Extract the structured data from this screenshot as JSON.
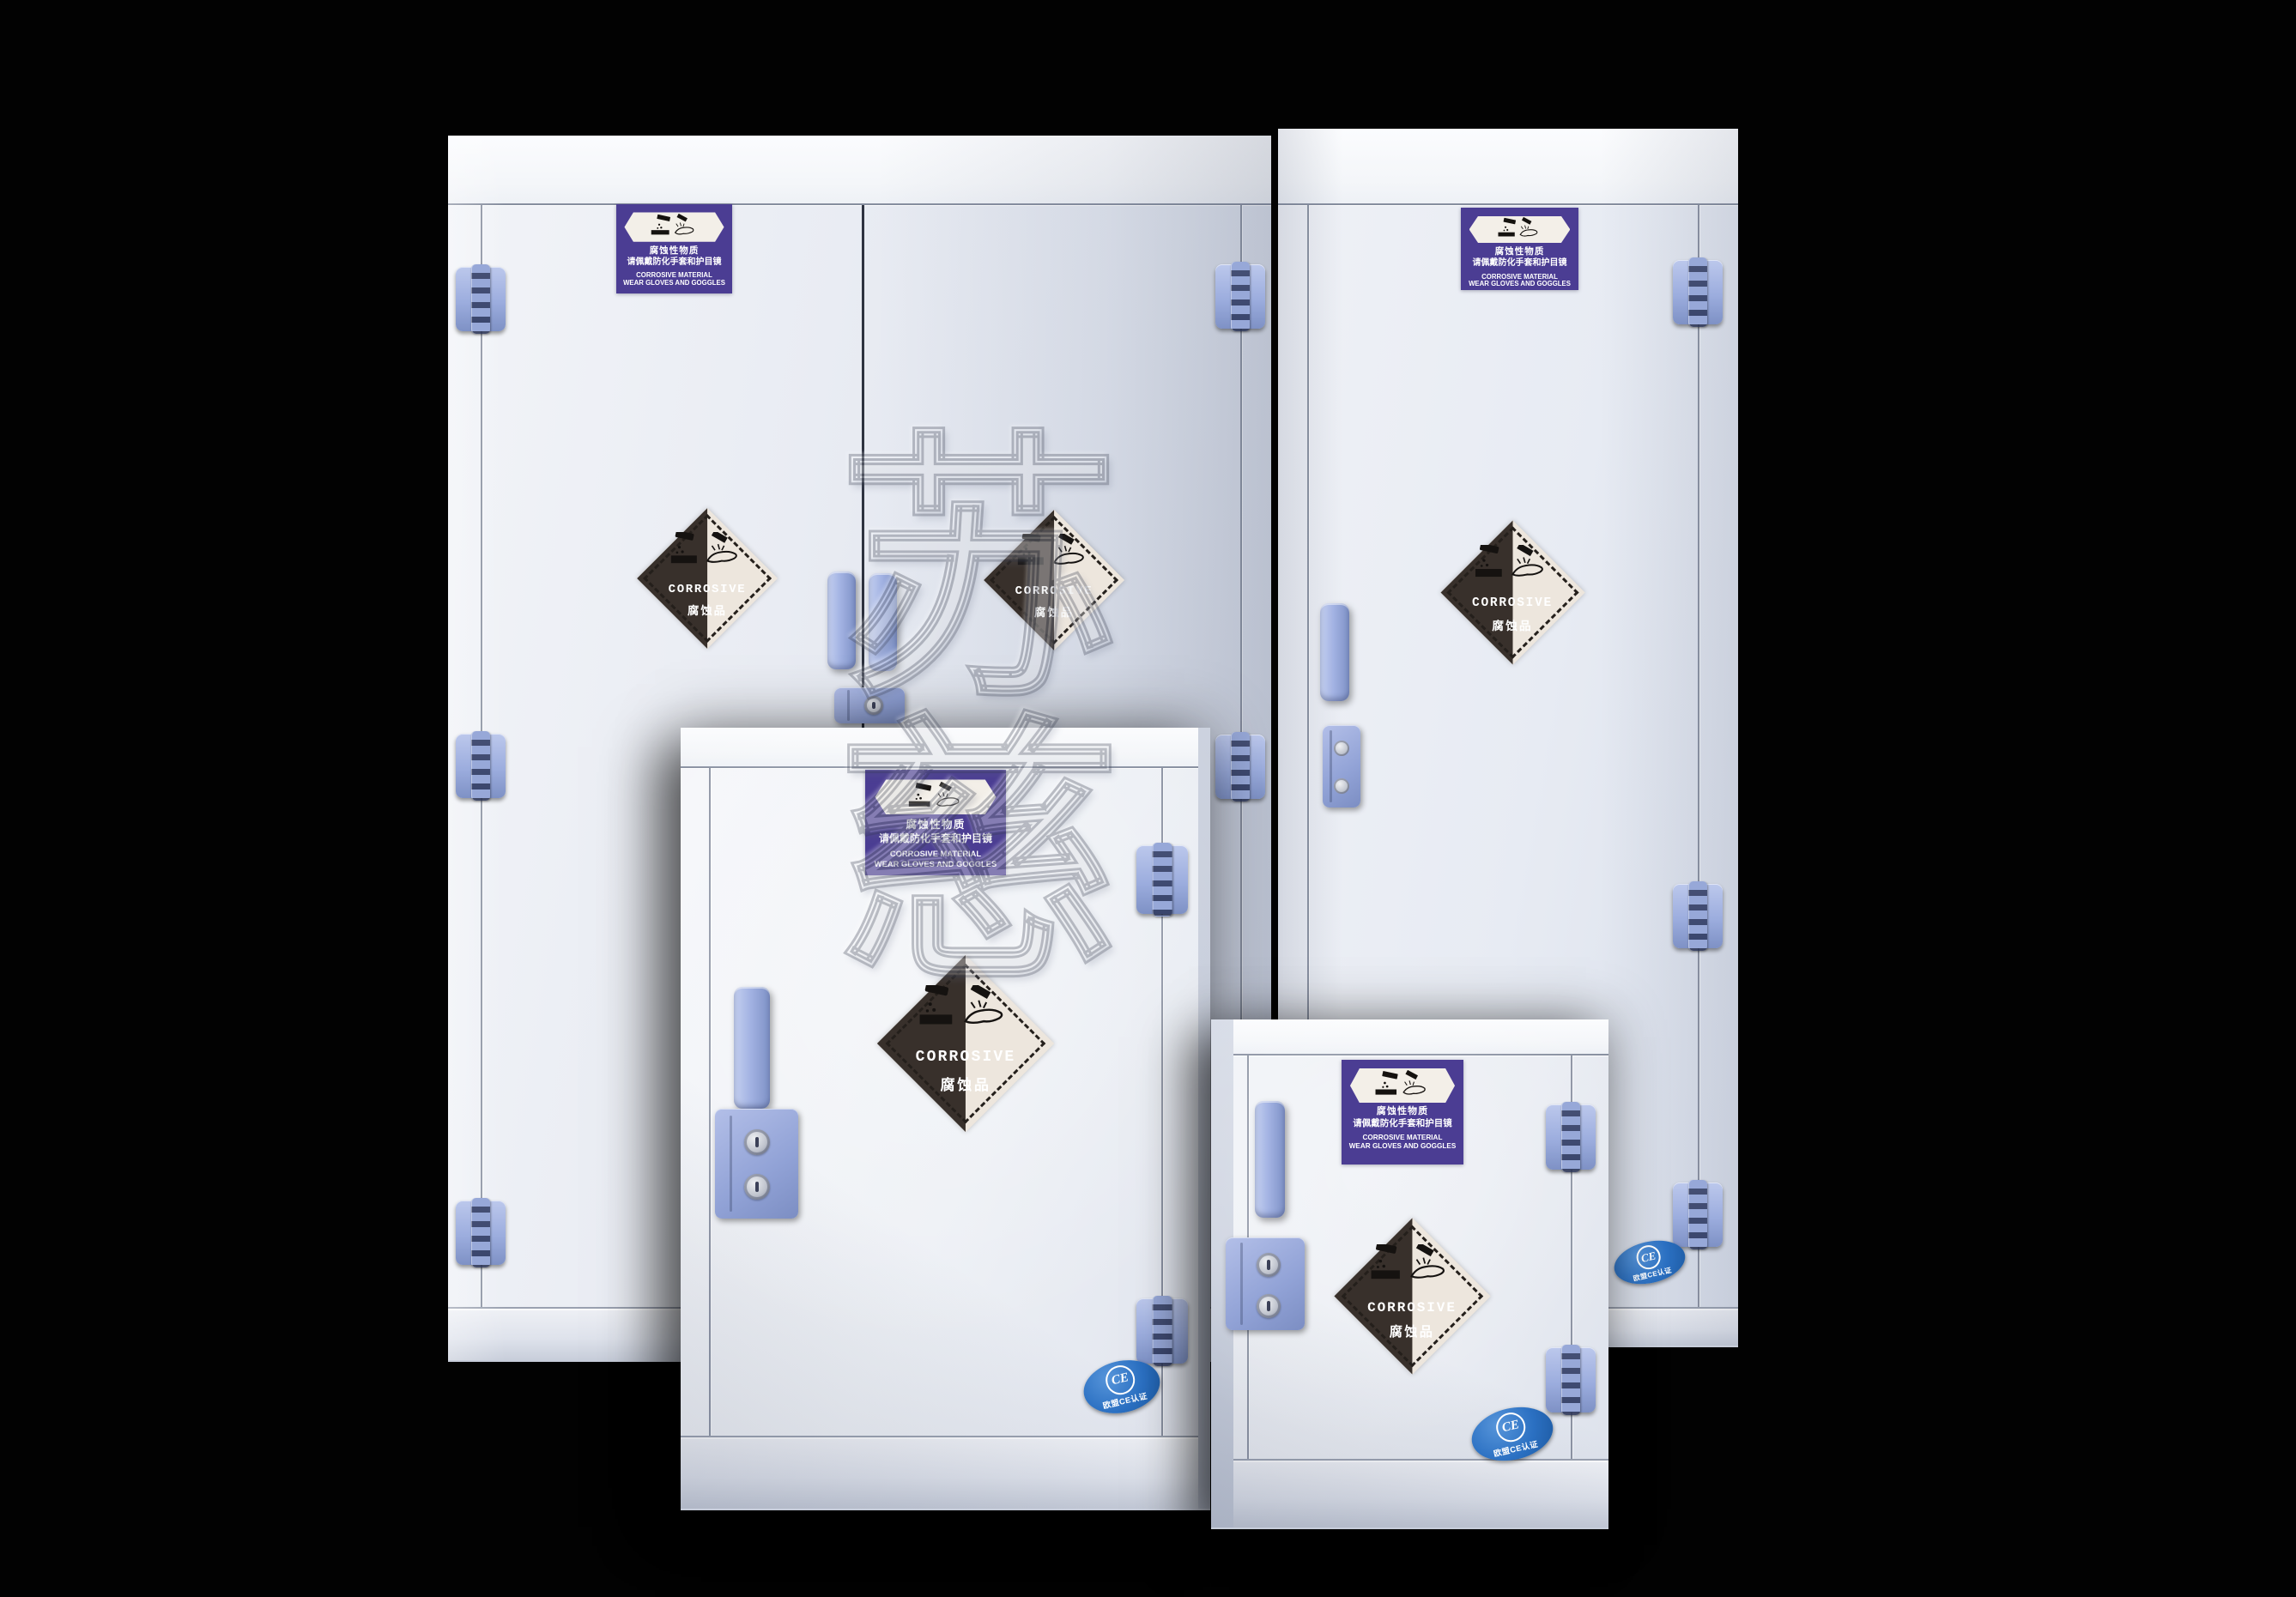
{
  "scene": {
    "background_color": "#000000",
    "watermark_text": "苏慈"
  },
  "decals": {
    "warning_label": {
      "bg_color": "#4b3d93",
      "line1_zh": "腐蚀性物质",
      "line2_zh": "请佩戴防化手套和护目镜",
      "line3_en": "CORROSIVE MATERIAL",
      "line4_en": "WEAR GLOVES AND GOGGLES"
    },
    "corrosive_diamond": {
      "bg_color": "#ede6dd",
      "triangle_color": "#38302b",
      "title_en": "CORROSIVE",
      "title_zh": "腐蚀品"
    },
    "ce_badge": {
      "bg_color": "#2b70c2",
      "logo": "CE",
      "text_zh": "欧盟CE认证"
    }
  },
  "hardware": {
    "color": "#9dafe0",
    "items": [
      "door-hinge",
      "door-handle",
      "door-lock"
    ]
  },
  "cabinets": [
    {
      "id": "large-double-door-cabinet",
      "doors": 2,
      "decals": [
        "warning-label",
        "corrosive-diamond",
        "corrosive-diamond"
      ]
    },
    {
      "id": "tall-single-door-cabinet",
      "doors": 1,
      "decals": [
        "warning-label",
        "corrosive-diamond",
        "ce-badge"
      ]
    },
    {
      "id": "medium-single-door-cabinet",
      "doors": 1,
      "decals": [
        "warning-label",
        "corrosive-diamond",
        "ce-badge"
      ]
    },
    {
      "id": "small-single-door-cabinet",
      "doors": 1,
      "decals": [
        "warning-label",
        "corrosive-diamond",
        "ce-badge"
      ]
    }
  ]
}
